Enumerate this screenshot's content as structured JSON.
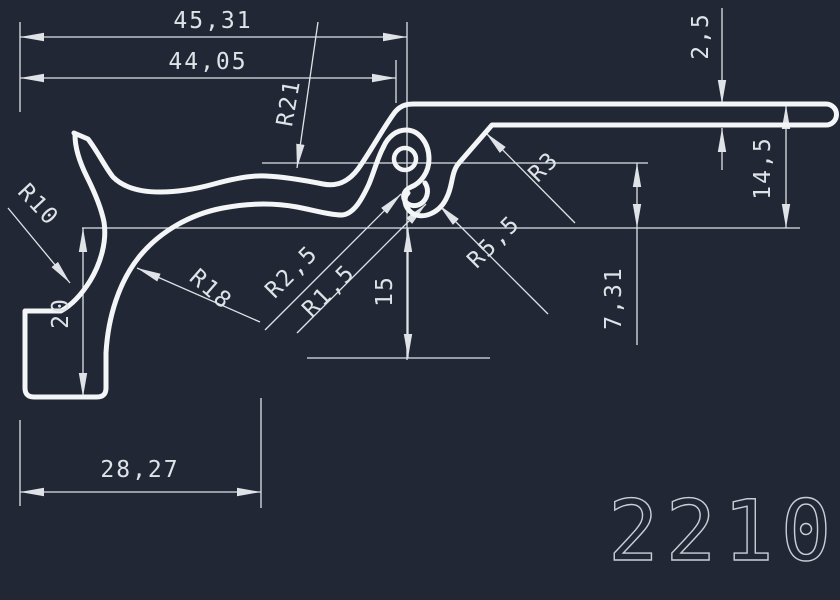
{
  "drawing": {
    "part_number": "2210",
    "linear_dimensions": {
      "total_width": "45,31",
      "upper_width": "44,05",
      "flange_thickness": "2,5",
      "right_height": "14,5",
      "hook_offset": "7,31",
      "center_depth": "15",
      "left_height": "20",
      "foot_width": "28,27"
    },
    "radius_labels": {
      "r21": "R21",
      "r10": "R10",
      "r18": "R18",
      "r2_5": "R2,5",
      "r1_5": "R1,5",
      "r5_5": "R5,5",
      "r3": "R3"
    },
    "colors": {
      "background": "#212734",
      "profile_line": "#f3f5f7",
      "dimension_line": "#dfe3e8",
      "title": "#c9ced5"
    }
  }
}
